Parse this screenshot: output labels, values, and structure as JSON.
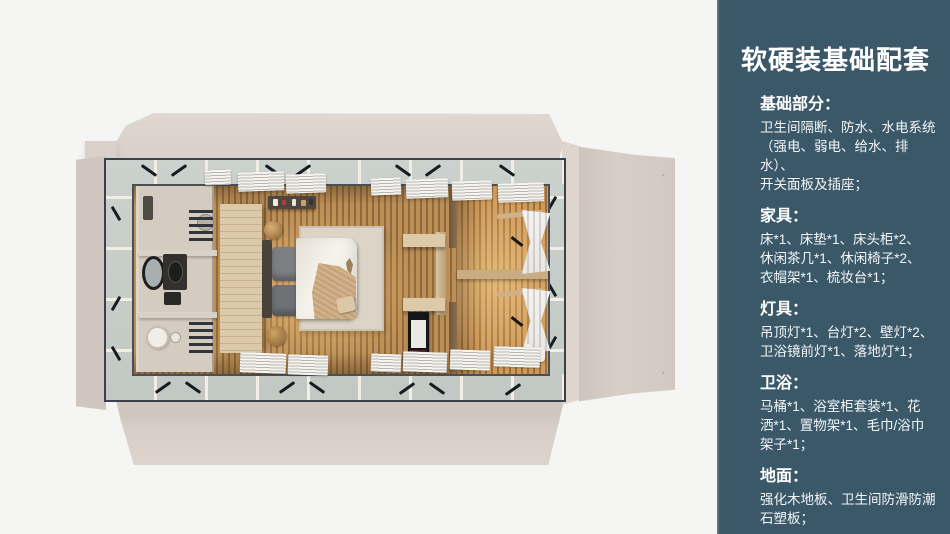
{
  "panel": {
    "title": "软硬装基础配套",
    "sections": [
      {
        "heading": "基础部分：",
        "body": "卫生间隔断、防水、水电系统\n（强电、弱电、给水、排水）、\n开关面板及插座；"
      },
      {
        "heading": "家具：",
        "body": "床*1、床垫*1、床头柜*2、\n休闲茶几*1、休闲椅子*2、\n衣帽架*1、梳妆台*1；"
      },
      {
        "heading": "灯具：",
        "body": "吊顶灯*1、台灯*2、壁灯*2、\n卫浴镜前灯*1、落地灯*1；"
      },
      {
        "heading": "卫浴：",
        "body": "马桶*1、浴室柜套装*1、花\n洒*1、置物架*1、毛巾/浴巾\n架子*1；"
      },
      {
        "heading": "地面：",
        "body": "强化木地板、卫生间防滑防潮\n石塑板；"
      }
    ]
  },
  "colors": {
    "page_bg": "#f5f5f4",
    "panel_bg": "#3b5869",
    "panel_border": "#5b7486",
    "panel_text": "#ffffff",
    "exterior_flap": "#d7cfc7",
    "glass_band": "#c6ccc7",
    "frame_line": "#3a414d",
    "wood_floor": "#bd8f55",
    "wood_floor_dark": "#8f6a3f",
    "warm_glow": "#ffd087",
    "bathroom_floor": "#d4ccc1",
    "wardrobe_wood": "#dcc9a9",
    "bed_duvet": "#f1eee7",
    "bed_throw": "#c7a379",
    "pillow_grey": "#7d7f84"
  }
}
